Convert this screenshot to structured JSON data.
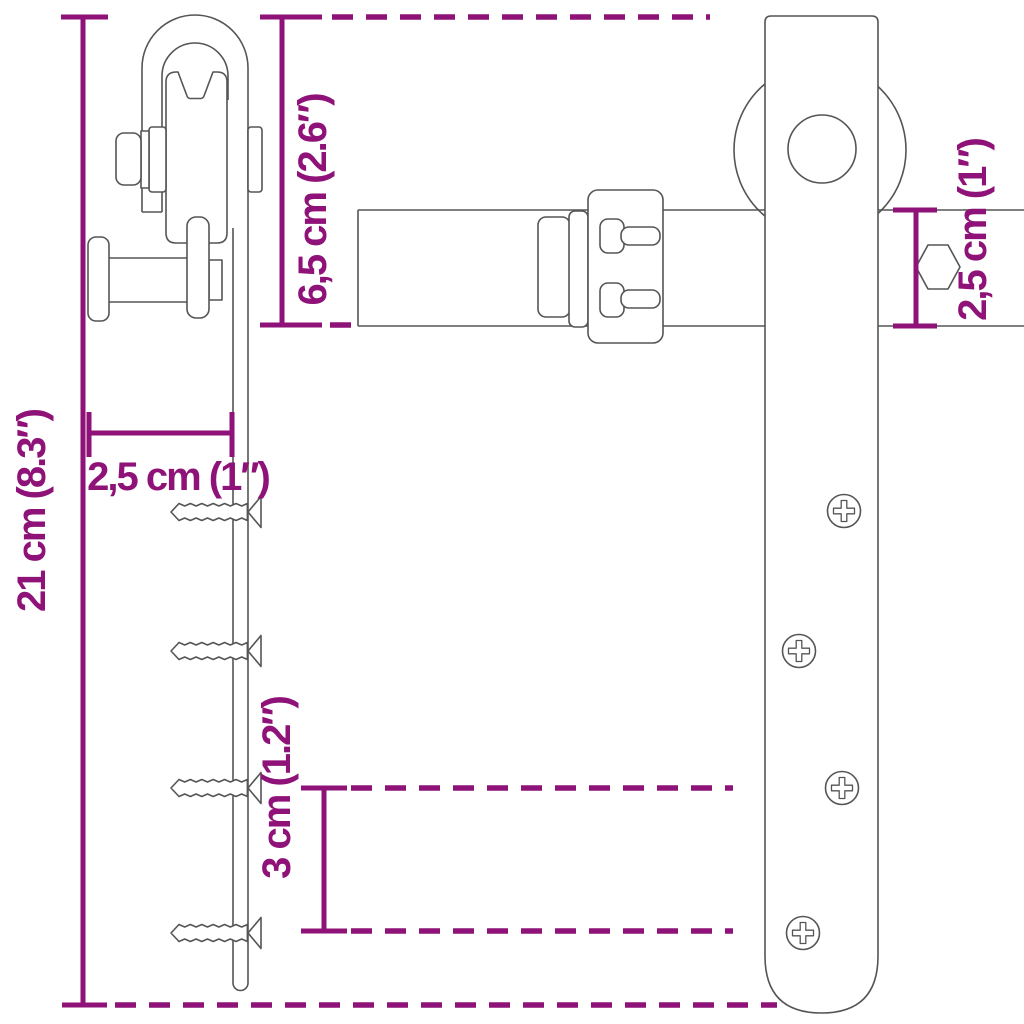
{
  "colors": {
    "dimension": "#8E1277",
    "outline": "#555555",
    "background": "#FFFFFF"
  },
  "measurements": {
    "strap_length": {
      "label": "21 cm (8.3″)",
      "orientation": "vertical"
    },
    "roller_height": {
      "label": "6,5 cm (2.6″)",
      "orientation": "vertical"
    },
    "bracket_depth": {
      "label": "2,5 cm (1″)",
      "orientation": "horizontal"
    },
    "screw_spacing": {
      "label": "3 cm (1.2″)",
      "orientation": "vertical"
    },
    "rail_width": {
      "label": "2,5 cm (1″)",
      "orientation": "vertical"
    }
  }
}
